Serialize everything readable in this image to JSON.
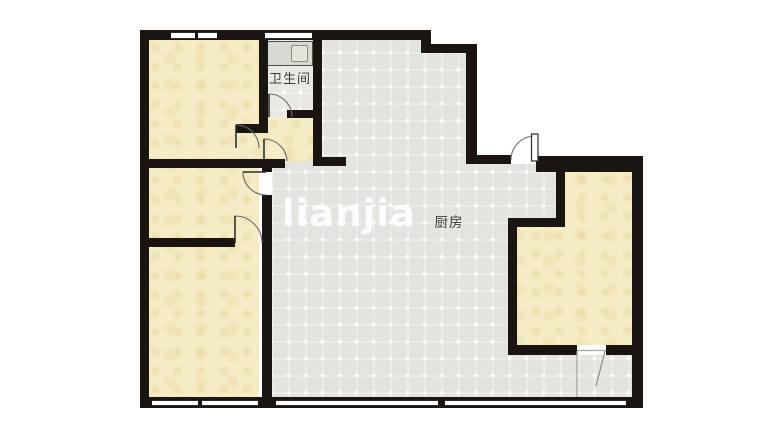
{
  "floor_plan": {
    "rooms": {
      "bathroom": {
        "label": "卫生间"
      },
      "kitchen": {
        "label": "厨房"
      }
    },
    "watermark": "LIANJIA",
    "colors": {
      "wall": "#1a1511",
      "room_fill": "#f5ecc6",
      "floor_fill": "#e3e4e0",
      "bathroom_fill": "#e8e8e4",
      "background": "#ffffff"
    }
  }
}
